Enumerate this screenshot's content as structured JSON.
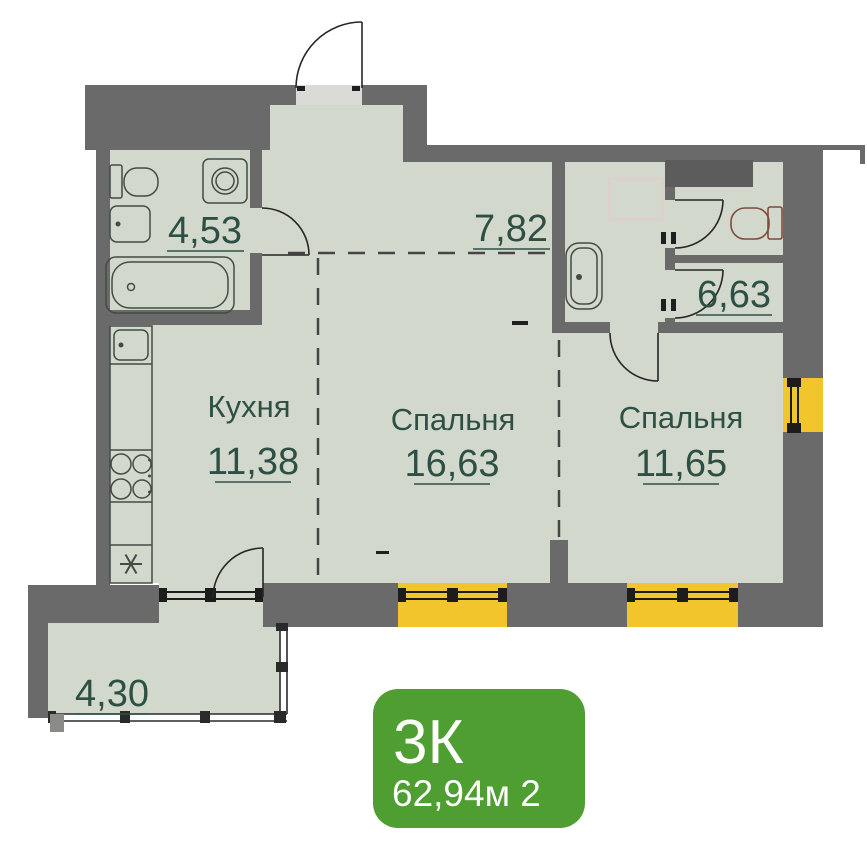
{
  "rooms": {
    "bathroom_main": {
      "area": "4,53"
    },
    "hallway": {
      "area": "7,82"
    },
    "bathroom_small": {
      "area": "6,63"
    },
    "kitchen": {
      "name": "Кухня",
      "area": "11,38"
    },
    "bedroom_center": {
      "name": "Спальня",
      "area": "16,63"
    },
    "bedroom_right": {
      "name": "Спальня",
      "area": "11,65"
    },
    "balcony": {
      "area": "4,30"
    }
  },
  "badge": {
    "type": "3К",
    "area": "62,94м 2"
  },
  "colors": {
    "wall": "#6a6a6a",
    "shaft": "#5c5c5c",
    "floor": "#d3d8cd",
    "window_accent": "#f2c52d",
    "badge_green": "#4f9e31",
    "label_text": "#2e5044",
    "fixture_stroke": "#434c44",
    "toilet_accent": "#7d4b3c"
  },
  "icons": {
    "fixtures": [
      "toilet-icon",
      "washing-machine-icon",
      "sink-icon",
      "bathtub-icon",
      "stove-icon",
      "fridge-icon",
      "shower-tray-icon"
    ]
  }
}
